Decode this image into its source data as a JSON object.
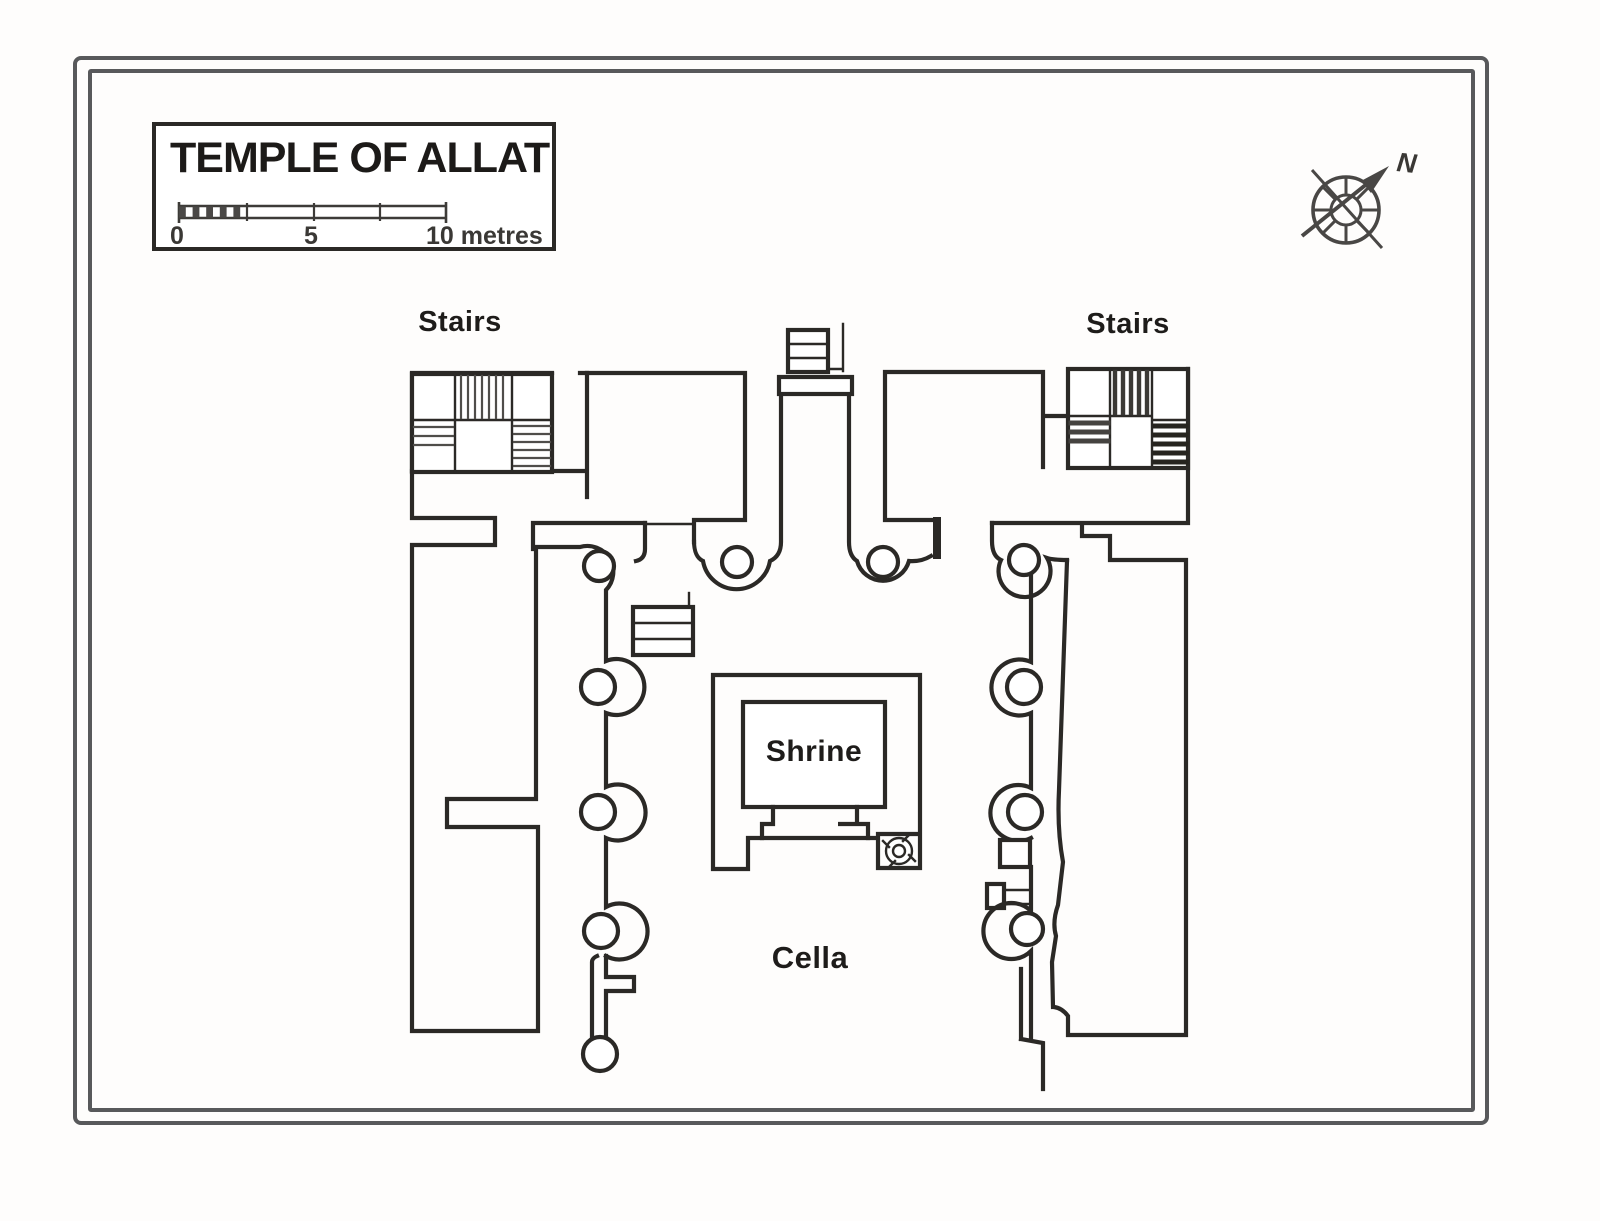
{
  "legend": {
    "title": "TEMPLE OF ALLAT",
    "scale": {
      "zero": "0",
      "five": "5",
      "ten": "10 metres"
    }
  },
  "compass": {
    "north": "N"
  },
  "labels": {
    "stairs_west": "Stairs",
    "stairs_east": "Stairs",
    "shrine": "Shrine",
    "cella": "Cella"
  },
  "colors": {
    "ink": "#2b2926",
    "frame": "#58595b",
    "paper": "#fefdfc"
  }
}
